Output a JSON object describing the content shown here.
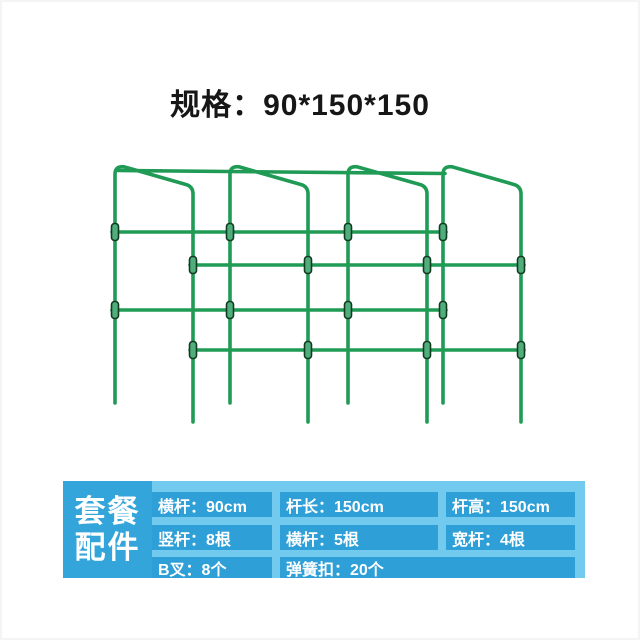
{
  "title": "规格：90*150*150",
  "panel": {
    "label_line1": "套餐",
    "label_line2": "配件",
    "rows": [
      {
        "cells": [
          "横杆：90cm",
          "杆长：150cm",
          "杆高：150cm"
        ]
      },
      {
        "cells": [
          "竖杆：8根",
          "横杆：5根",
          "宽杆：4根"
        ]
      },
      {
        "cells": [
          "B叉：8个",
          "弹簧扣：20个"
        ]
      }
    ]
  },
  "illustration": {
    "name": "garden-trellis-diagram",
    "frame_count": "4",
    "clip_count_visible": "16"
  },
  "colors": {
    "trellis_green": "#1f9b55",
    "clip_fill_green": "#4fae7c",
    "clip_outline": "#123b22",
    "panel_light_blue": "#72cbee",
    "panel_cell_blue": "#2f9fd7",
    "panel_label_blue": "#33a5da",
    "title_color": "#161616",
    "text_white": "#ffffff"
  }
}
